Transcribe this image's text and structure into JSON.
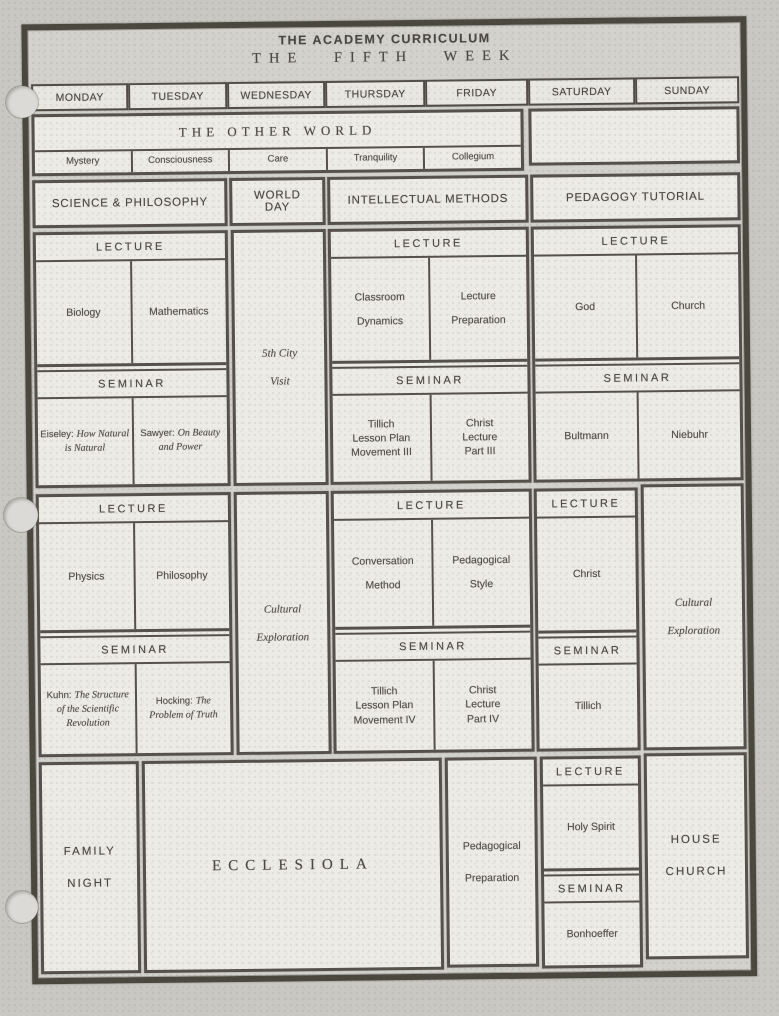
{
  "title": {
    "line1": "THE ACADEMY CURRICULUM",
    "line2": "THE FIFTH WEEK"
  },
  "days": [
    "MONDAY",
    "TUESDAY",
    "WEDNESDAY",
    "THURSDAY",
    "FRIDAY",
    "SATURDAY",
    "SUNDAY"
  ],
  "labels": {
    "lecture": "LECTURE",
    "seminar": "SEMINAR"
  },
  "other_world": {
    "title": "THE OTHER WORLD",
    "subjects": [
      "Mystery",
      "Consciousness",
      "Care",
      "Tranquility",
      "Collegium"
    ]
  },
  "sections": {
    "science_philosophy": "SCIENCE & PHILOSOPHY",
    "world_day": {
      "lines": [
        "WORLD",
        "DAY"
      ]
    },
    "intellectual_methods": "INTELLECTUAL METHODS",
    "pedagogy_tutorial": "PEDAGOGY TUTORIAL"
  },
  "session1": {
    "science_philosophy": {
      "lecture": [
        "Biology",
        "Mathematics"
      ],
      "seminar": [
        {
          "author": "Eiseley:",
          "title": "How Natural is Natural"
        },
        {
          "author": "Sawyer:",
          "title": "On Beauty and Power"
        }
      ]
    },
    "world_day": {
      "lines": [
        "5th City",
        "Visit"
      ]
    },
    "intellectual_methods": {
      "lecture": [
        {
          "lines": [
            "Classroom",
            "Dynamics"
          ]
        },
        {
          "lines": [
            "Lecture",
            "Preparation"
          ]
        }
      ],
      "seminar": [
        {
          "lines": [
            "Tillich",
            "Lesson Plan",
            "Movement III"
          ]
        },
        {
          "lines": [
            "Christ",
            "Lecture",
            "Part III"
          ]
        }
      ]
    },
    "pedagogy_tutorial": {
      "lecture": [
        "God",
        "Church"
      ],
      "seminar": [
        "Bultmann",
        "Niebuhr"
      ]
    }
  },
  "session2": {
    "science_philosophy": {
      "lecture": [
        "Physics",
        "Philosophy"
      ],
      "seminar": [
        {
          "author": "Kuhn:",
          "title": "The Structure of the Scientific Revolution"
        },
        {
          "author": "Hocking:",
          "title": "The Problem of Truth"
        }
      ]
    },
    "world_day": {
      "lines": [
        "Cultural",
        "Exploration"
      ]
    },
    "intellectual_methods": {
      "lecture": [
        {
          "lines": [
            "Conversation",
            "Method"
          ]
        },
        {
          "lines": [
            "Pedagogical",
            "Style"
          ]
        }
      ],
      "seminar": [
        {
          "lines": [
            "Tillich",
            "Lesson Plan",
            "Movement IV"
          ]
        },
        {
          "lines": [
            "Christ",
            "Lecture",
            "Part IV"
          ]
        }
      ]
    },
    "saturday": {
      "lecture": "Christ",
      "seminar": "Tillich"
    },
    "sunday": {
      "lines": [
        "Cultural",
        "Exploration"
      ]
    }
  },
  "evening": {
    "monday": {
      "lines": [
        "FAMILY",
        "NIGHT"
      ]
    },
    "tue_thu": "ECCLESIOLA",
    "friday": {
      "lines": [
        "Pedagogical",
        "Preparation"
      ]
    },
    "saturday": {
      "lecture": "Holy Spirit",
      "seminar": "Bonhoeffer"
    },
    "sunday": {
      "lines": [
        "HOUSE",
        "CHURCH"
      ]
    }
  },
  "colors": {
    "paper": "#c9c8c3",
    "cell": "#edebe5",
    "ink": "#534f48",
    "border": "#55514a"
  }
}
